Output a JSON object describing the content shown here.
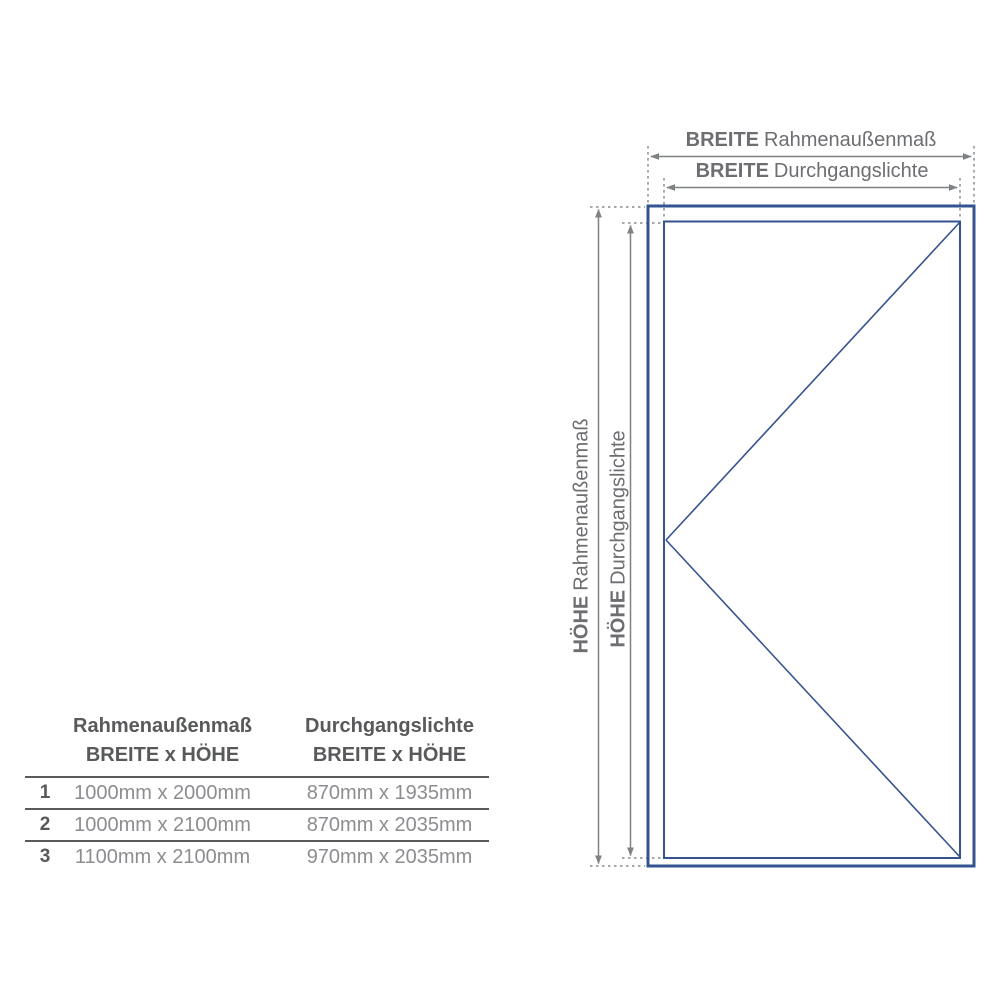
{
  "diagram": {
    "labels": {
      "breite_aussen": {
        "b": "BREITE",
        "t": "Rahmenaußenmaß"
      },
      "breite_innen": {
        "b": "BREITE",
        "t": "Durchgangslichte"
      },
      "hoehe_aussen": {
        "b": "HÖHE",
        "t": "Rahmenaußenmaß"
      },
      "hoehe_innen": {
        "b": "HÖHE",
        "t": "Durchgangslichte"
      }
    },
    "colors": {
      "frame_blue": "#35538f",
      "dimension_gray": "#7f8285",
      "extension_gray": "#8a8c8f",
      "label_gray": "#6d6e71",
      "table_dark_gray": "#58595b",
      "table_value_gray": "#8b8d90"
    }
  },
  "table": {
    "headers": [
      {
        "line1": "Rahmenaußenmaß",
        "line2": "BREITE x HÖHE"
      },
      {
        "line1": "Durchgangslichte",
        "line2": "BREITE x HÖHE"
      }
    ],
    "rows": [
      {
        "num": "1",
        "rahmenaussenmass": "1000mm x 2000mm",
        "durchgangslichte": "870mm x 1935mm"
      },
      {
        "num": "2",
        "rahmenaussenmass": "1000mm x 2100mm",
        "durchgangslichte": "870mm x 2035mm"
      },
      {
        "num": "3",
        "rahmenaussenmass": "1100mm x 2100mm",
        "durchgangslichte": "970mm x 2035mm"
      }
    ]
  }
}
